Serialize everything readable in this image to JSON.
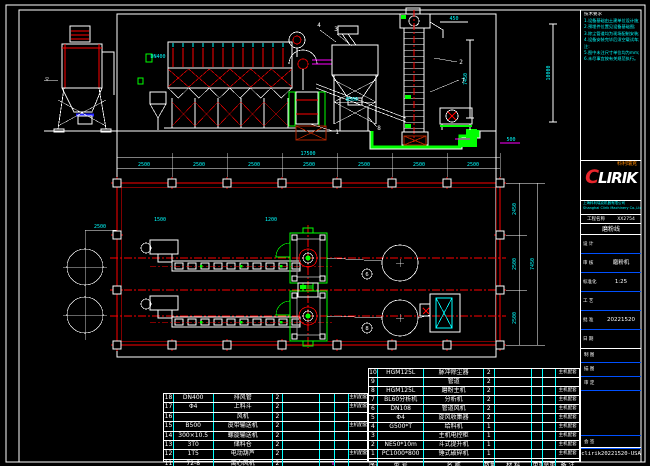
{
  "colors": {
    "bg": "#000000",
    "line": "#ffffff",
    "red": "#ff0000",
    "cyan": "#00ffff",
    "green": "#00ff00",
    "magenta": "#ff00ff",
    "blue": "#0050ff",
    "orange": "#ff8800",
    "logo_red": "#e8262c"
  },
  "notes": {
    "title": "技术要求",
    "lines": [
      "1.设备基础由土建单位设计施工;",
      "2.预埋件位置见设备基础图;",
      "3.除尘管道均为现场配制安装;",
      "4.设备安装完毕后须空载试车;",
      "注:",
      "5.图中未注尺寸单位均为mm;",
      "6.未尽事宜按有关规范执行。"
    ]
  },
  "logo": {
    "brand_c": "C",
    "brand_rest": "LIRIK",
    "brand_cn": "科利瑞克",
    "addr1": "上海科利瑞克机器有限公司",
    "addr2": "Shanghai Clirik Machinery Co.,Ltd"
  },
  "titleblock": {
    "prow_left": "工程名称",
    "prow_right": "XX2754",
    "product_name": "磨粉线",
    "rows": [
      {
        "label": "设 计",
        "value": ""
      },
      {
        "label": "审 核",
        "value": "磨粉机"
      },
      {
        "label": "标准化",
        "value": "1:25"
      },
      {
        "label": "工 艺",
        "value": ""
      },
      {
        "label": "批 准",
        "value": "20221520"
      },
      {
        "label": "日 期",
        "value": ""
      }
    ],
    "rows2": [
      {
        "label": "制 图"
      },
      {
        "label": "描 图"
      },
      {
        "label": "审 定"
      }
    ],
    "sign_row": "会 签",
    "doc_no": "clirik20221520-USA"
  },
  "bom": {
    "header": [
      "序号",
      "型 号",
      "名 称",
      "数量",
      "材 料",
      "单重",
      "总重",
      "备 注"
    ],
    "left_rows": [
      [
        "18",
        "DN400",
        "排风管",
        "2",
        "",
        "",
        "",
        "主机配套1#"
      ],
      [
        "17",
        "Φ4",
        "上料斗",
        "2",
        "",
        "",
        "",
        "主机配套1#"
      ],
      [
        "16",
        "",
        "风机",
        "2",
        "",
        "",
        "",
        ""
      ],
      [
        "15",
        "B500",
        "皮带输送机",
        "2",
        "",
        "",
        "",
        "主机配套"
      ],
      [
        "14",
        "300×10.5",
        "螺旋输送机",
        "2",
        "",
        "",
        "",
        ""
      ],
      [
        "13",
        "3T0",
        "储料仓",
        "2",
        "",
        "",
        "",
        ""
      ],
      [
        "12",
        "1T5",
        "电动葫芦",
        "2",
        "",
        "",
        "",
        "主机配套"
      ],
      [
        "11",
        "72-8",
        "离心风机",
        "2",
        "",
        "",
        "",
        ""
      ]
    ],
    "right_rows": [
      [
        "10",
        "HGM125L",
        "脉冲除尘器",
        "2",
        "",
        "",
        "",
        "主机配套"
      ],
      [
        "9",
        "",
        "管道",
        "2",
        "",
        "",
        "",
        ""
      ],
      [
        "8",
        "HGM125L",
        "磨粉主机",
        "2",
        "",
        "",
        "",
        "主机配套"
      ],
      [
        "7",
        "BL60分析机",
        "分析机",
        "2",
        "",
        "",
        "",
        "主机配套"
      ],
      [
        "6",
        "DN108",
        "管道风机",
        "2",
        "",
        "",
        "",
        "主机配套"
      ],
      [
        "5",
        "Φ4",
        "旋风收集器",
        "2",
        "",
        "",
        "",
        "主机配套"
      ],
      [
        "4",
        "G500*T",
        "给料机",
        "1",
        "",
        "",
        "",
        "主机配套"
      ],
      [
        "3",
        "",
        "主机电控柜",
        "1",
        "",
        "",
        "",
        "主机配套"
      ],
      [
        "2",
        "NE50*10m",
        "斗式提升机",
        "1",
        "",
        "",
        "",
        "主机配套"
      ],
      [
        "1",
        "PC1000*800",
        "锤式破碎机",
        "1",
        "",
        "",
        "",
        "主机配套"
      ]
    ]
  },
  "drawing": {
    "texts": [
      {
        "t": "2500",
        "x": 144,
        "y": 166
      },
      {
        "t": "2500",
        "x": 199,
        "y": 166
      },
      {
        "t": "2500",
        "x": 254,
        "y": 166
      },
      {
        "t": "2500",
        "x": 309,
        "y": 166
      },
      {
        "t": "2500",
        "x": 364,
        "y": 166
      },
      {
        "t": "2500",
        "x": 419,
        "y": 166
      },
      {
        "t": "2500",
        "x": 473,
        "y": 166
      },
      {
        "t": "17500",
        "x": 308,
        "y": 155
      },
      {
        "t": "2450",
        "x": 516,
        "y": 209,
        "r": -90
      },
      {
        "t": "2500",
        "x": 516,
        "y": 264,
        "r": -90
      },
      {
        "t": "2500",
        "x": 516,
        "y": 318,
        "r": -90
      },
      {
        "t": "7450",
        "x": 534,
        "y": 264,
        "r": -90
      },
      {
        "t": "10000",
        "x": 550,
        "y": 73,
        "r": -90
      },
      {
        "t": "7450",
        "x": 467,
        "y": 79,
        "r": -90
      },
      {
        "t": "450",
        "x": 454,
        "y": 20
      },
      {
        "t": "500",
        "x": 511,
        "y": 141
      },
      {
        "t": "B500",
        "x": 352,
        "y": 101
      },
      {
        "t": "DN400",
        "x": 158,
        "y": 58
      },
      {
        "t": "2500",
        "x": 100,
        "y": 228
      },
      {
        "t": "1500",
        "x": 160,
        "y": 221
      },
      {
        "t": "1200",
        "x": 271,
        "y": 221
      },
      {
        "t": "▽",
        "x": 47,
        "y": 81,
        "c": "#ffffff",
        "fs": 6
      }
    ],
    "balloons_plain": [
      {
        "n": "1",
        "x": 337,
        "y": 134
      },
      {
        "n": "8",
        "x": 379,
        "y": 130
      },
      {
        "n": "2",
        "x": 461,
        "y": 64
      },
      {
        "n": "7",
        "x": 463,
        "y": 83
      },
      {
        "n": "3",
        "x": 336,
        "y": 31
      },
      {
        "n": "4",
        "x": 319,
        "y": 27
      }
    ],
    "balloons_circled": [
      {
        "n": "6",
        "x": 367,
        "y": 274
      },
      {
        "n": "8",
        "x": 367,
        "y": 328
      }
    ]
  }
}
